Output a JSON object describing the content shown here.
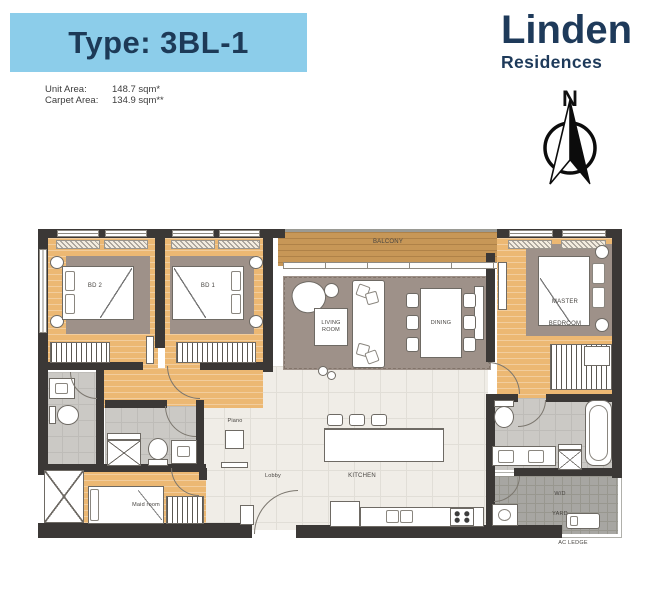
{
  "header": {
    "type_title": "Type: 3BL-1",
    "unit_area_label": "Unit Area:",
    "unit_area_value": "148.7 sqm*",
    "carpet_area_label": "Carpet Area:",
    "carpet_area_value": "134.9 sqm**"
  },
  "brand": {
    "name": "Linden",
    "subtitle": "Residences"
  },
  "compass": {
    "north_label": "N"
  },
  "plan": {
    "labels": {
      "balcony": "BALCONY",
      "bd2": "BD 2",
      "bd1": "BD 1",
      "living": [
        "LIVING",
        "ROOM"
      ],
      "dining": "DINING",
      "master": [
        "MASTER",
        "BEDROOM"
      ],
      "piano": "Piano",
      "lobby": "Lobby",
      "kitchen": "KITCHEN",
      "maid": "Maid room",
      "wd_yard": [
        "W/D",
        "YARD"
      ],
      "ac_ledge": "AC LEDGE"
    },
    "colors": {
      "banner_blue": "#8ccdea",
      "navy": "#1e3a5a",
      "wall": "#3b3836",
      "wood": "#ecb873",
      "balcony_wood": "#c79757",
      "rug": "#9e9189",
      "tile": "#f0ede7",
      "bath_tile": "#cbc9c5",
      "yard_gray": "#a7a6a2"
    }
  }
}
